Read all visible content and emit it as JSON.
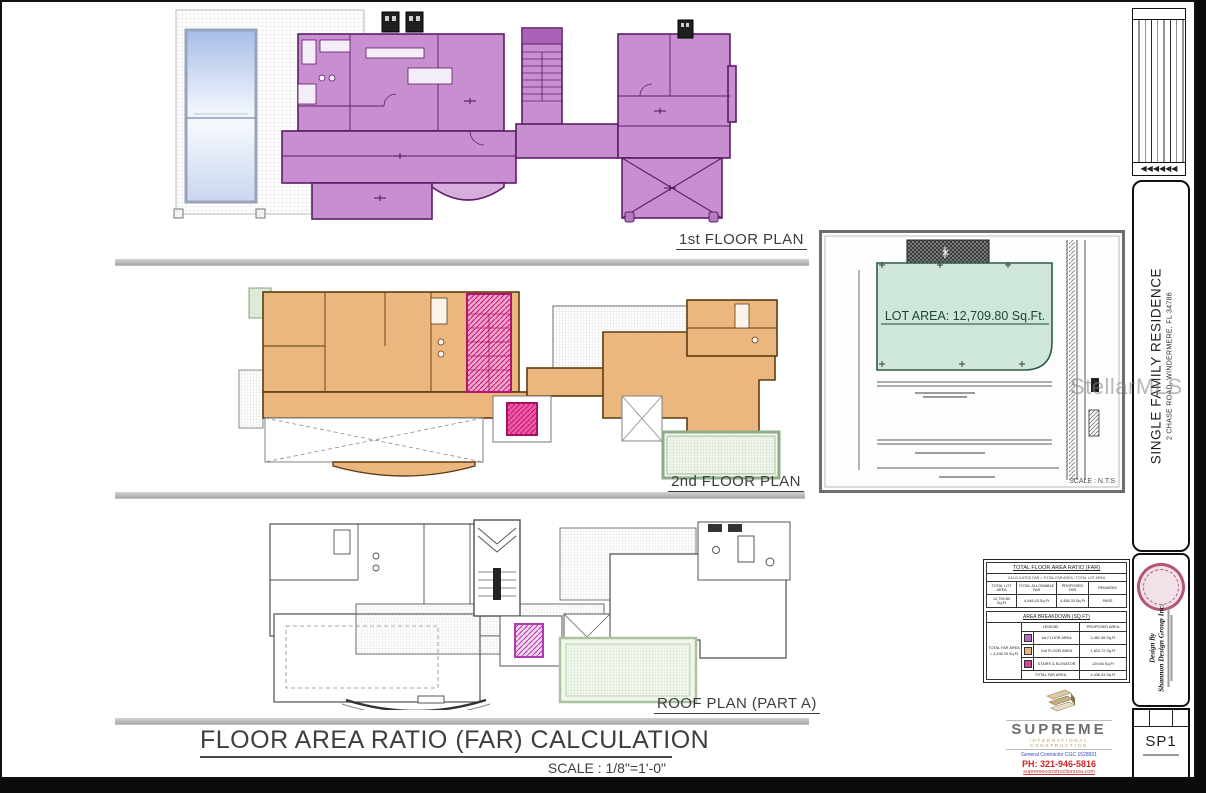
{
  "page": {
    "plan_labels": {
      "first": "1st FLOOR PLAN",
      "second": "2nd FLOOR PLAN",
      "roof": "ROOF PLAN (PART A)"
    },
    "title": "FLOOR AREA RATIO (FAR) CALCULATION",
    "title_scale": "SCALE : 1/8\"=1'-0\"",
    "watermark": "StellarMLS"
  },
  "site_plan": {
    "lot_area": "LOT AREA: 12,709.80 Sq.Ft.",
    "scale": "SCALE : N.T.S"
  },
  "far_tables": {
    "ratio": {
      "title": "TOTAL FLOOR AREA RATIO (FAR)",
      "note": "CALCULATED FAR = TOTAL FAR AREA / TOTAL LOT AREA",
      "headers": [
        "TOTAL LOT AREA",
        "TOTAL ALLOWABLE FAR",
        "PROPOSED FAR",
        "REMARKS"
      ],
      "values": [
        "12,709.80 Sq.Ft",
        "4,448.43 Sq.Ft",
        "4,436.33 Sq.Ft",
        "PASS"
      ]
    },
    "breakdown": {
      "title": "AREA BREAKDOWN (SQ.FT)",
      "side_label_1": "TOTAL FAR AREA",
      "side_label_2": "= 4,436.33 Sq.Ft",
      "col_legend": "LEGEND",
      "col_area": "PROPOSED AREA",
      "rows": [
        {
          "color": "#b66cc4",
          "label": "1st FLOOR AREA",
          "value": "2,481.95 Sq.Ft"
        },
        {
          "color": "#ecb77e",
          "label": "2nd FLOOR AREA",
          "value": "1,824.72 Sq.Ft"
        },
        {
          "color": "#d93f9b",
          "label": "STAIRS & ELEVATOR",
          "value": "129.66 Sq.Ft"
        },
        {
          "color": "",
          "label": "TOTAL FAR AREA",
          "value": "4,436.33 Sq.Ft"
        }
      ]
    }
  },
  "title_block": {
    "project_name": "SINGLE FAMILY RESIDENCE",
    "project_address": "2 CHASE ROAD, WINDERMERE, FL 34786",
    "design_by": "Design By",
    "designer": "Shannon Design Group Inc.",
    "sheet_number": "SP1",
    "rev_arrows": "◀◀◀◀◀◀"
  },
  "contractor": {
    "name": "SUPREME",
    "tagline": "INTERNATIONAL CONSTRUCTION",
    "license": "General Contractor CGC 1528931",
    "phone": "PH: 321-946-5816",
    "website": "supremeconstructionusa.com"
  },
  "colors": {
    "first_floor_fill": "#c88fd0",
    "second_floor_fill": "#ecb77e",
    "stair_fill": "#e85aa6",
    "lot_fill": "#cfe7d8"
  }
}
